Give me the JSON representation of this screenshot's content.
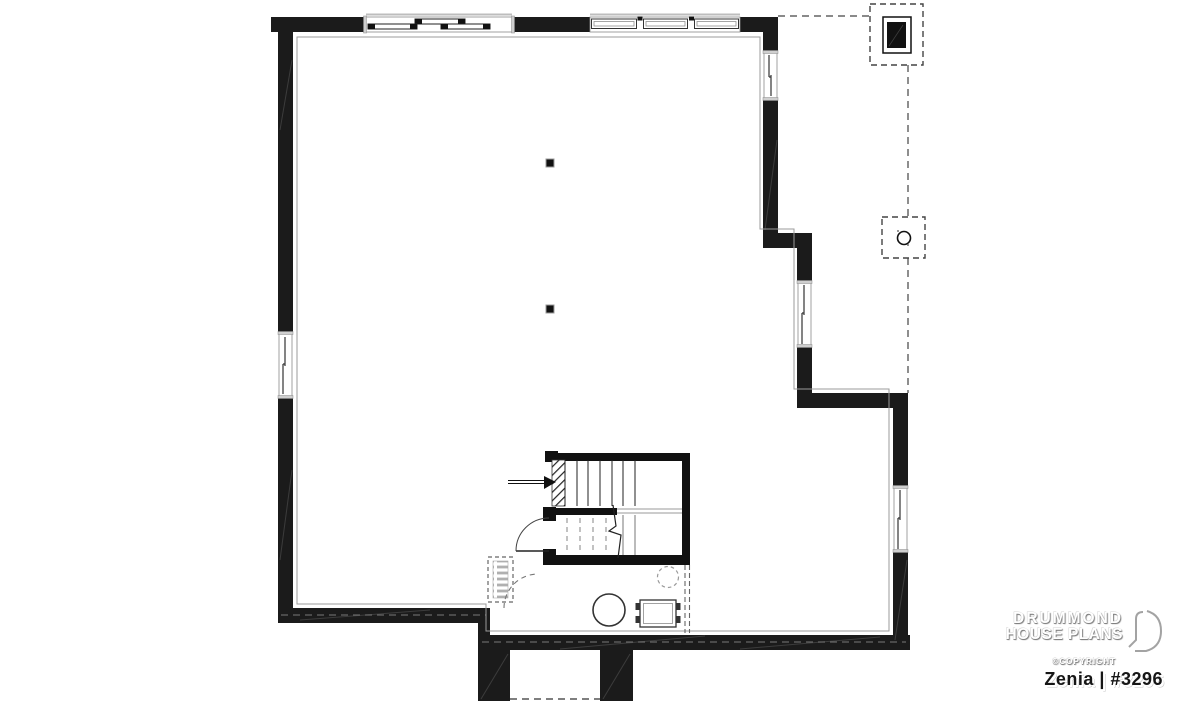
{
  "page": {
    "background": "#ffffff",
    "kind": "architectural basement floor plan drawing"
  },
  "branding": {
    "line1": "DRUMMOND",
    "line2": "HOUSE PLANS",
    "copyright": "©COPYRIGHT",
    "plan_title": "Zenia | #3296",
    "logo_icon": "drummond-d-logo"
  },
  "colors": {
    "wall_fill": "#1b1b1b",
    "outline": "#333333",
    "dashed_line": "#666666",
    "finish_line": "#999999",
    "tread_dash": "#9a9a9a",
    "background": "#ffffff",
    "brand_emboss": "#ffffff",
    "brand_shadow": "#7d7d7d",
    "title_text": "#161616"
  },
  "plan_elements": [
    "exterior-foundation-walls",
    "top-sliding-window",
    "top-triple-window",
    "left-sliding-window",
    "right-upper-window",
    "right-middle-window",
    "right-lower-window",
    "staircase-with-break-line",
    "stair-direction-arrow",
    "stair-door-swing",
    "future-door-swing-dashed",
    "future-wall-dashed",
    "future-fixture-dashed",
    "round-fixture",
    "laundry-tub",
    "floor-drain-dashed-circle",
    "fireplace-foundation-dashed",
    "support-post-dashed-box",
    "steel-column-1",
    "steel-column-2",
    "foundation-piers"
  ]
}
